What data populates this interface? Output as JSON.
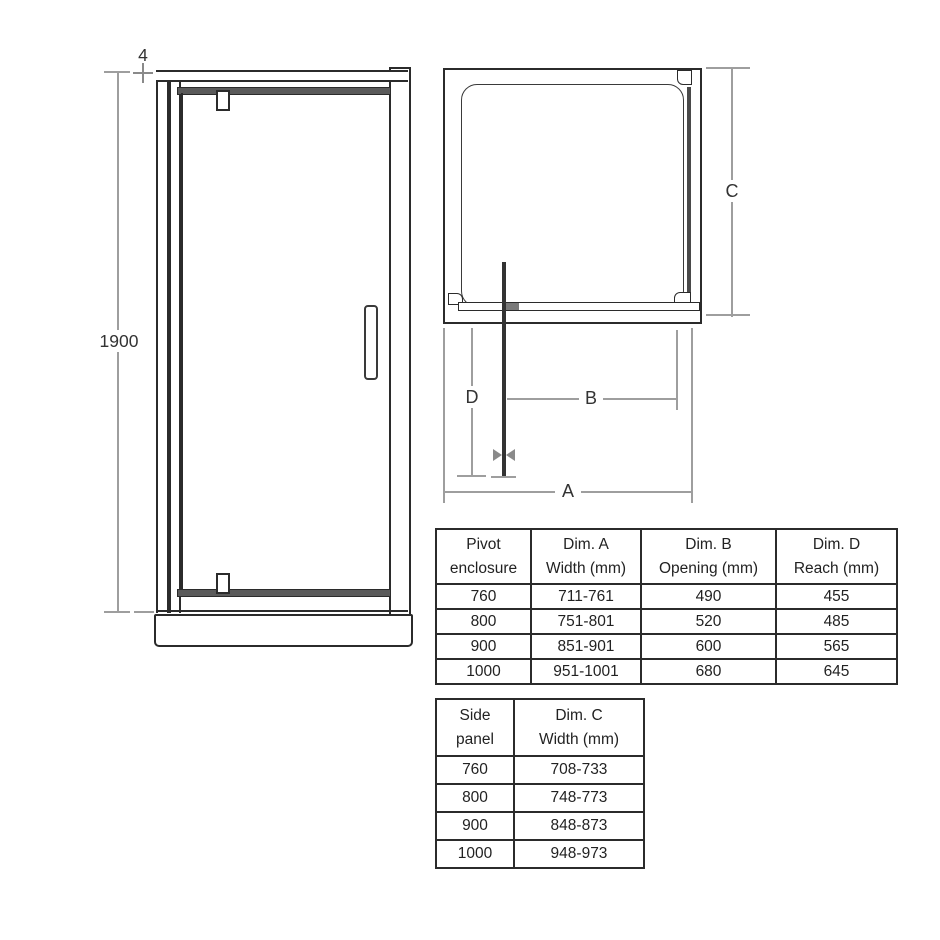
{
  "front_view": {
    "height_label": "1900",
    "top_adjustment_label": "4"
  },
  "plan_view": {
    "dim_a_label": "A",
    "dim_b_label": "B",
    "dim_c_label": "C",
    "dim_d_label": "D"
  },
  "pivot_table": {
    "headers": [
      [
        "Pivot",
        "enclosure"
      ],
      [
        "Dim. A",
        "Width (mm)"
      ],
      [
        "Dim. B",
        "Opening (mm)"
      ],
      [
        "Dim. D",
        "Reach (mm)"
      ]
    ],
    "rows": [
      [
        "760",
        "711-761",
        "490",
        "455"
      ],
      [
        "800",
        "751-801",
        "520",
        "485"
      ],
      [
        "900",
        "851-901",
        "600",
        "565"
      ],
      [
        "1000",
        "951-1001",
        "680",
        "645"
      ]
    ]
  },
  "side_table": {
    "headers": [
      [
        "Side",
        "panel"
      ],
      [
        "Dim. C",
        "Width (mm)"
      ]
    ],
    "rows": [
      [
        "760",
        "708-733"
      ],
      [
        "800",
        "748-773"
      ],
      [
        "900",
        "848-873"
      ],
      [
        "1000",
        "948-973"
      ]
    ]
  },
  "colors": {
    "drawing_line": "#2b2b2b",
    "dimension_line": "#9e9e9e",
    "rail_fill": "#5a5a5a",
    "background": "#ffffff"
  }
}
